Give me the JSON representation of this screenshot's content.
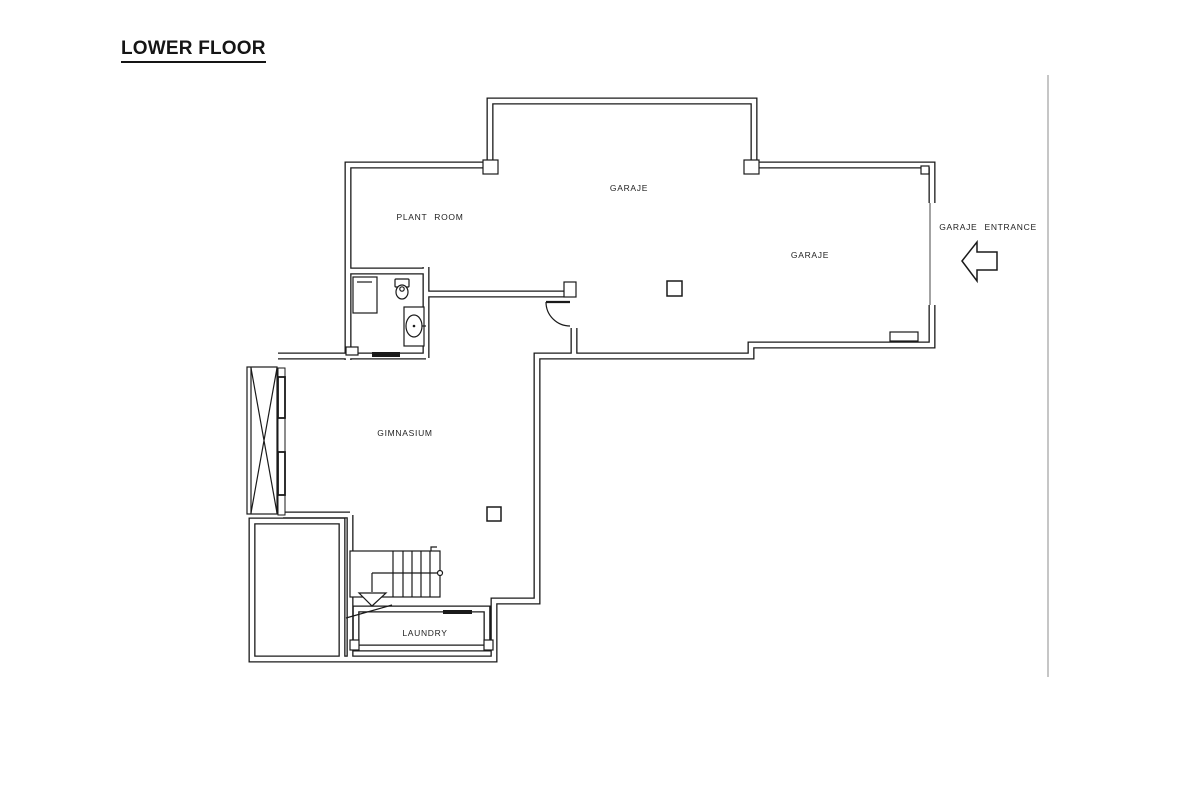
{
  "title": "LOWER FLOOR",
  "rooms": {
    "garaje_top": "GARAJE",
    "plant_room": "PLANT ROOM",
    "garaje_main": "GARAJE",
    "gimnasium": "GIMNASIUM",
    "laundry": "LAUNDRY"
  },
  "annotations": {
    "entrance": "GARAJE ENTRANCE"
  },
  "icons": {
    "entrance_arrow": "arrow-left"
  },
  "colors": {
    "wall": "#1a1a1a",
    "label": "#1f1f1f",
    "garage_opening_line": "#999999",
    "frame_line": "#b3b3b3",
    "background": "#ffffff"
  }
}
